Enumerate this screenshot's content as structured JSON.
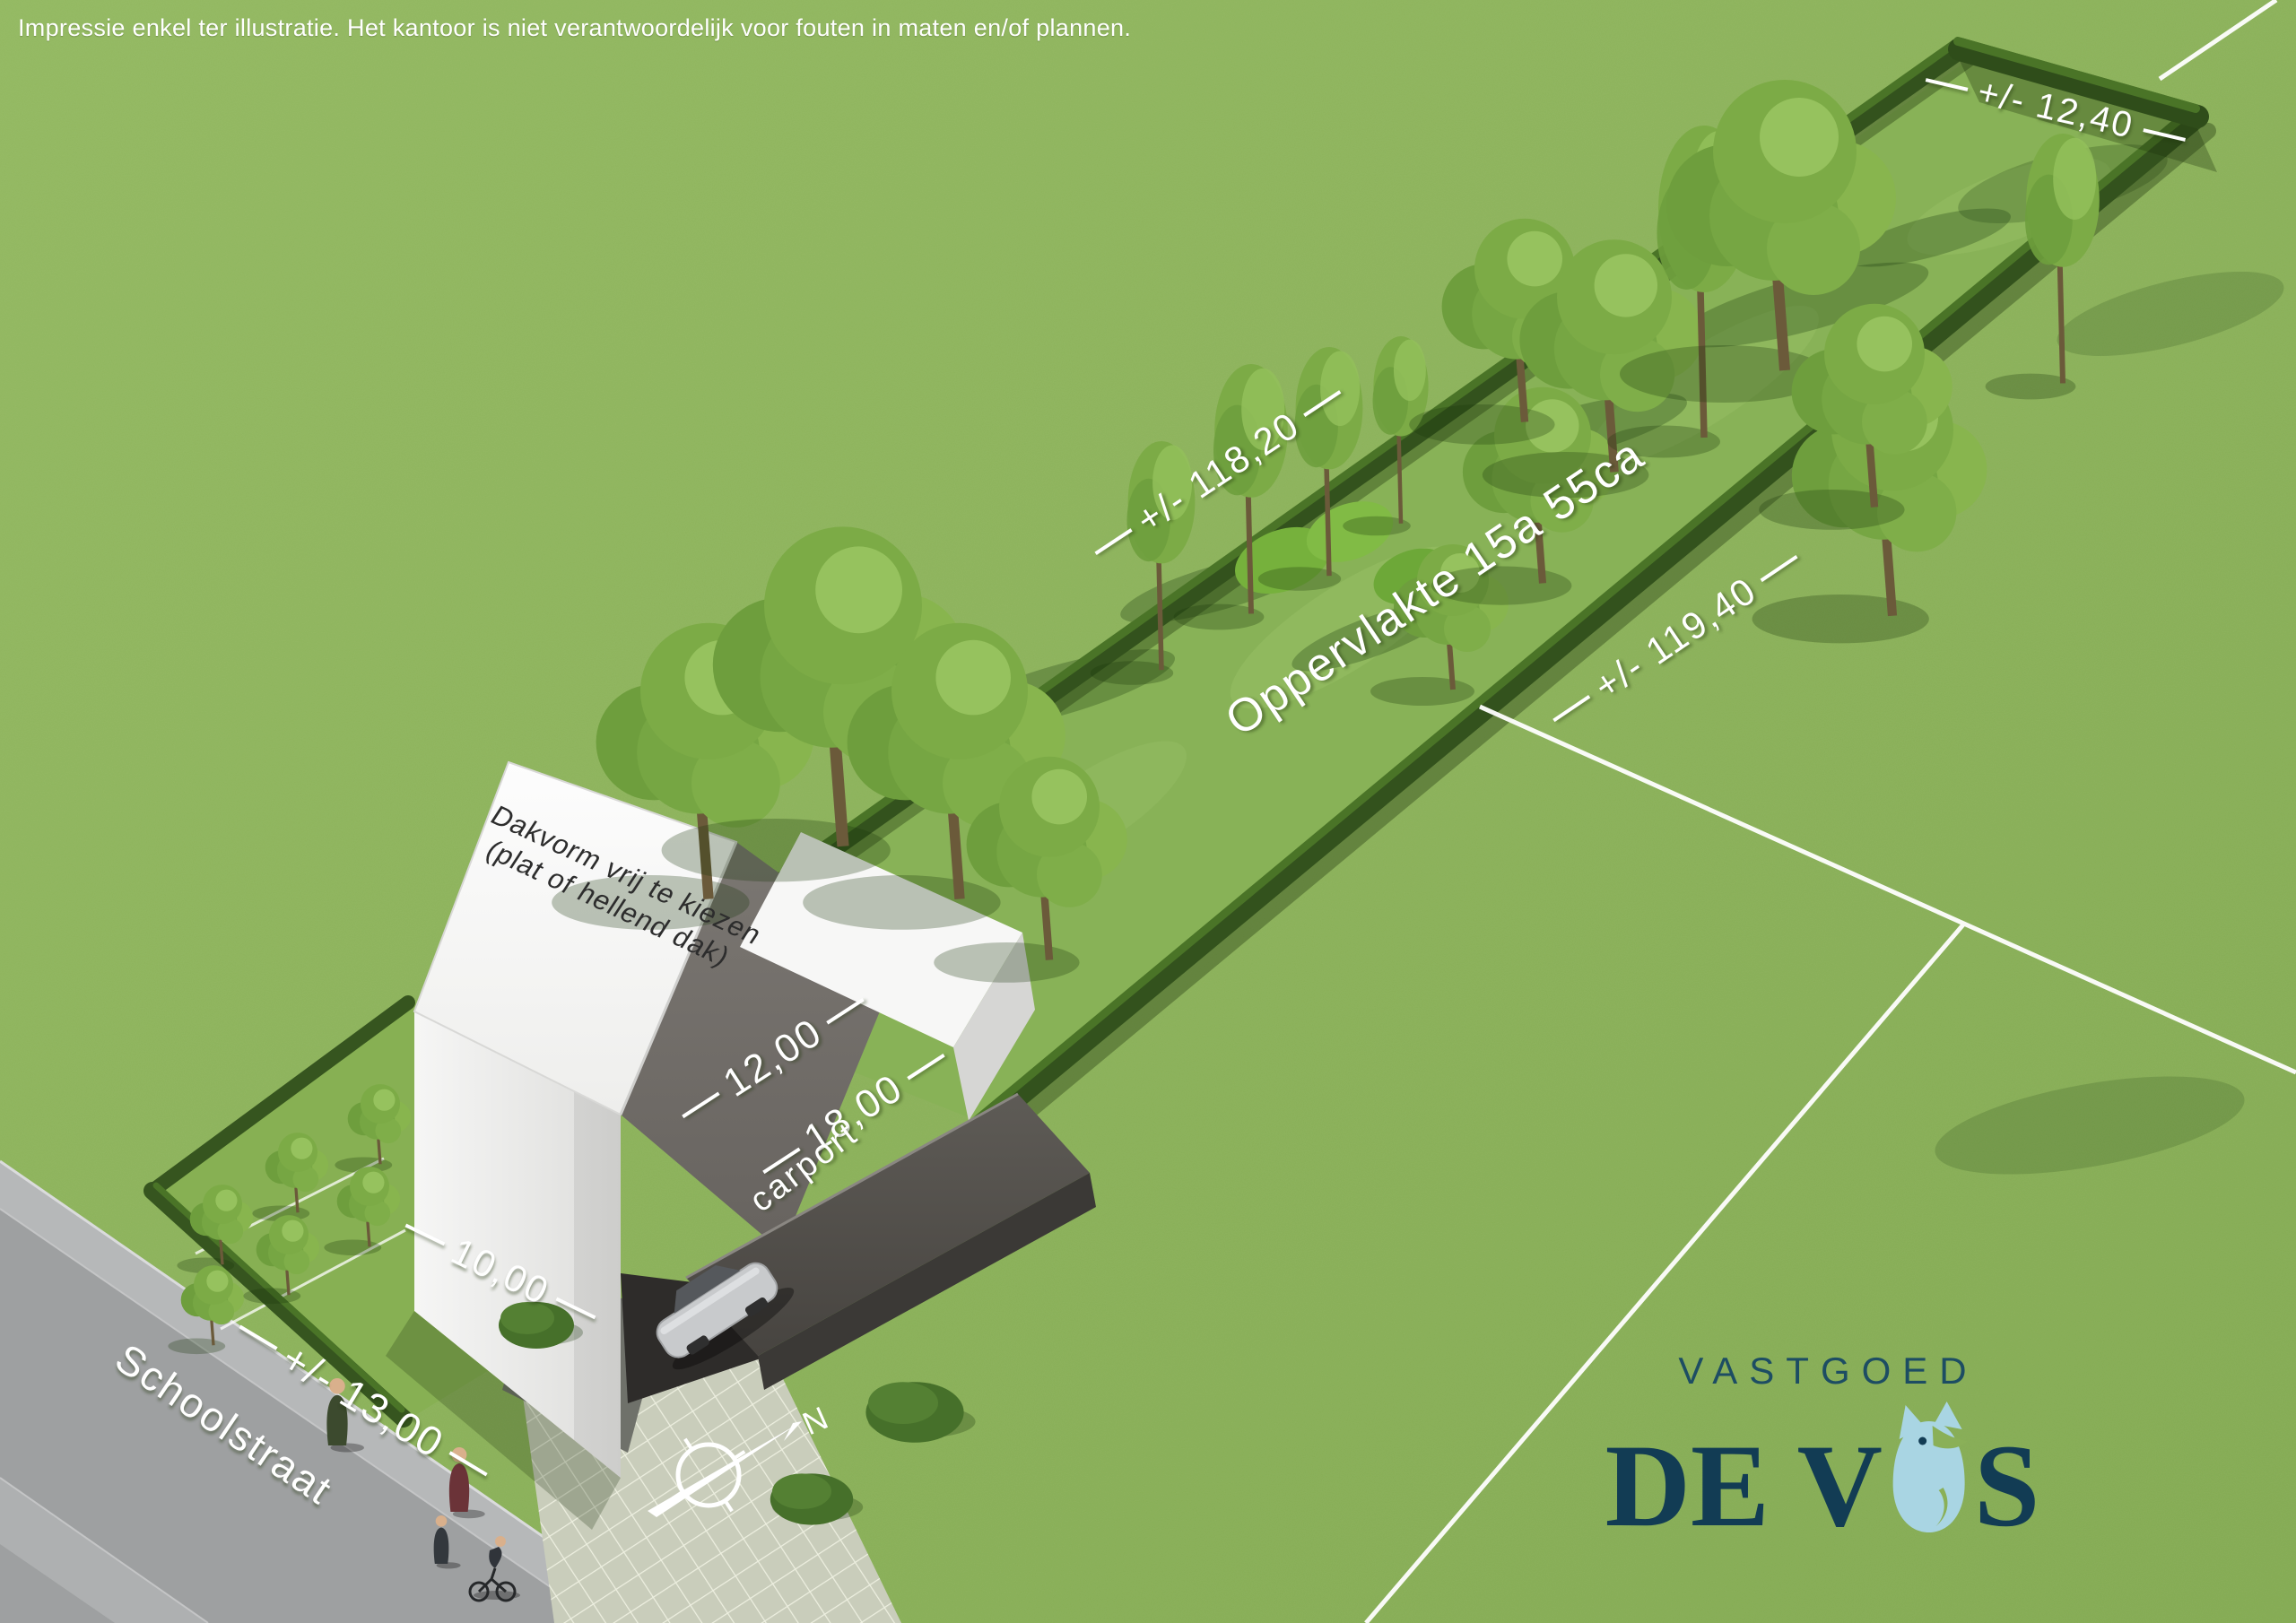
{
  "disclaimer": "Impressie enkel ter illustratie. Het kantoor is niet verantwoordelijk voor fouten in maten en/of plannen.",
  "plot": {
    "area_label": "Oppervlakte 15a 55ca",
    "length_left_label": "+/- 118,20",
    "length_right_label": "+/- 119,40",
    "width_rear_label": "+/- 12,40",
    "width_front_street_label": "+/- 13,00",
    "garden_width_label": "10,00",
    "house_depth_label": "12,00",
    "total_depth_label": "18,00"
  },
  "house": {
    "roof_note_line1": "Dakvorm vrij te kiezen",
    "roof_note_line2": "(plat of hellend dak)",
    "carport_label": "carport"
  },
  "street": {
    "name": "Schoolstraat"
  },
  "compass": {
    "north_label": "N"
  },
  "logo": {
    "line1": "VASTGOED",
    "line2_left": "DE V",
    "line2_right": "S",
    "fox_icon": "fox-icon"
  },
  "colors": {
    "grass": "#8ab058",
    "plot_grass": "#87b055",
    "hedge_dark": "#33521d",
    "street_gray": "#9ea0a1",
    "roof_white": "#fafafa",
    "roof_gray": "#6e6a66",
    "carport_gray": "#514e4a",
    "label_white": "#ffffff",
    "logo_navy": "#123c54",
    "logo_teal": "#1d4d63",
    "logo_fox_blue": "#a9d5e3"
  }
}
